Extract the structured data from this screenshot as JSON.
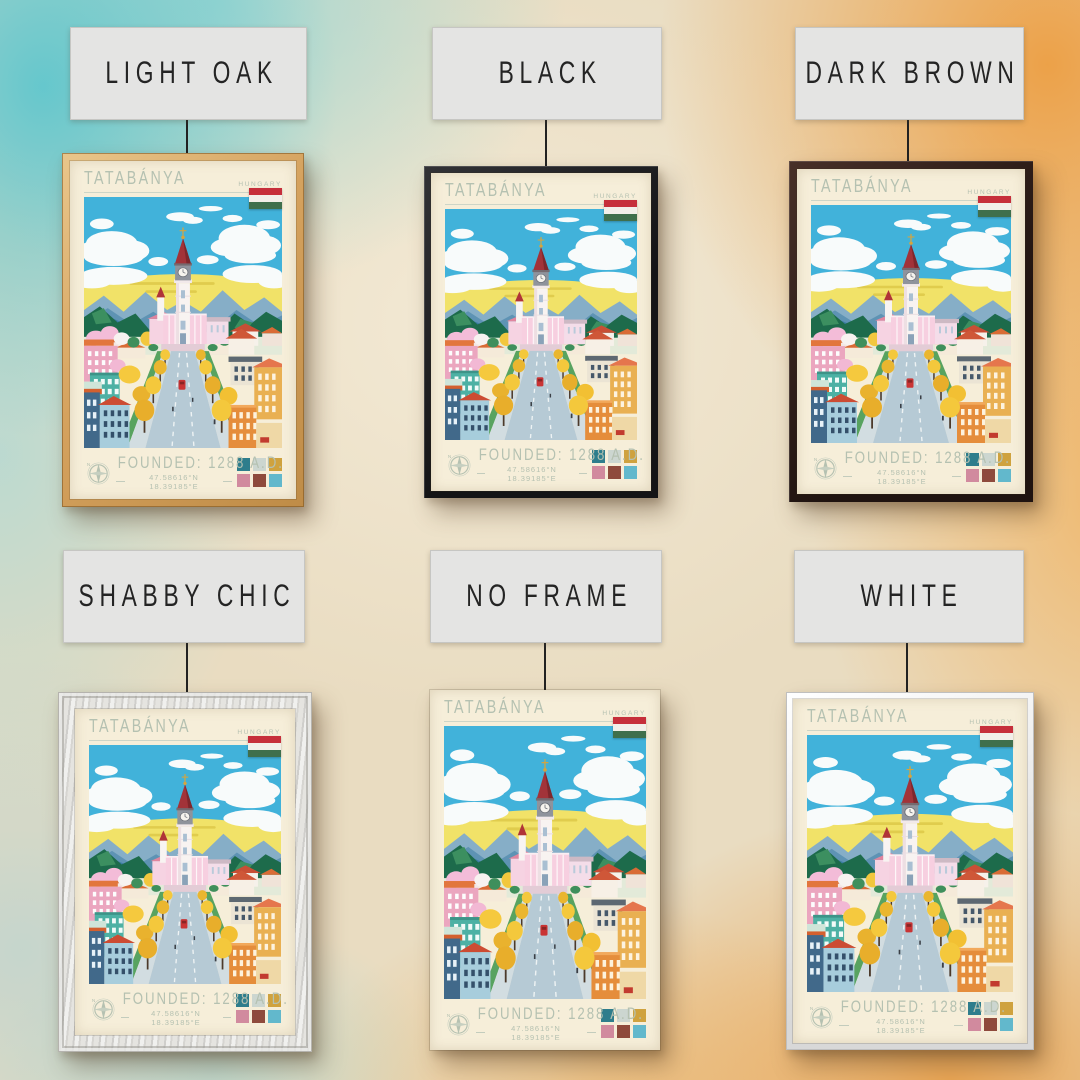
{
  "variants": [
    {
      "label": "LIGHT OAK",
      "frame_style": "light-oak"
    },
    {
      "label": "BLACK",
      "frame_style": "black"
    },
    {
      "label": "DARK BROWN",
      "frame_style": "dark-brown"
    },
    {
      "label": "SHABBY CHIC",
      "frame_style": "shabby-chic"
    },
    {
      "label": "NO FRAME",
      "frame_style": "no-frame"
    },
    {
      "label": "WHITE",
      "frame_style": "white"
    }
  ],
  "poster": {
    "title": "TATABÁNYA",
    "country": "HUNGARY",
    "founded": "FOUNDED: 1288 A.D.",
    "coordinates": "47.58616°N 18.39185°E",
    "flag_name": "hungary-flag",
    "flag_colors": [
      "#c62f3b",
      "#f2efe9",
      "#3f6f4c"
    ],
    "palette": [
      "#2e7d8c",
      "#ccd6d0",
      "#cfa23e",
      "#d18a9e",
      "#8e4a3c",
      "#62b8cc"
    ],
    "text_color": "#b5c1b1",
    "paper_color": "#f6eed9"
  }
}
